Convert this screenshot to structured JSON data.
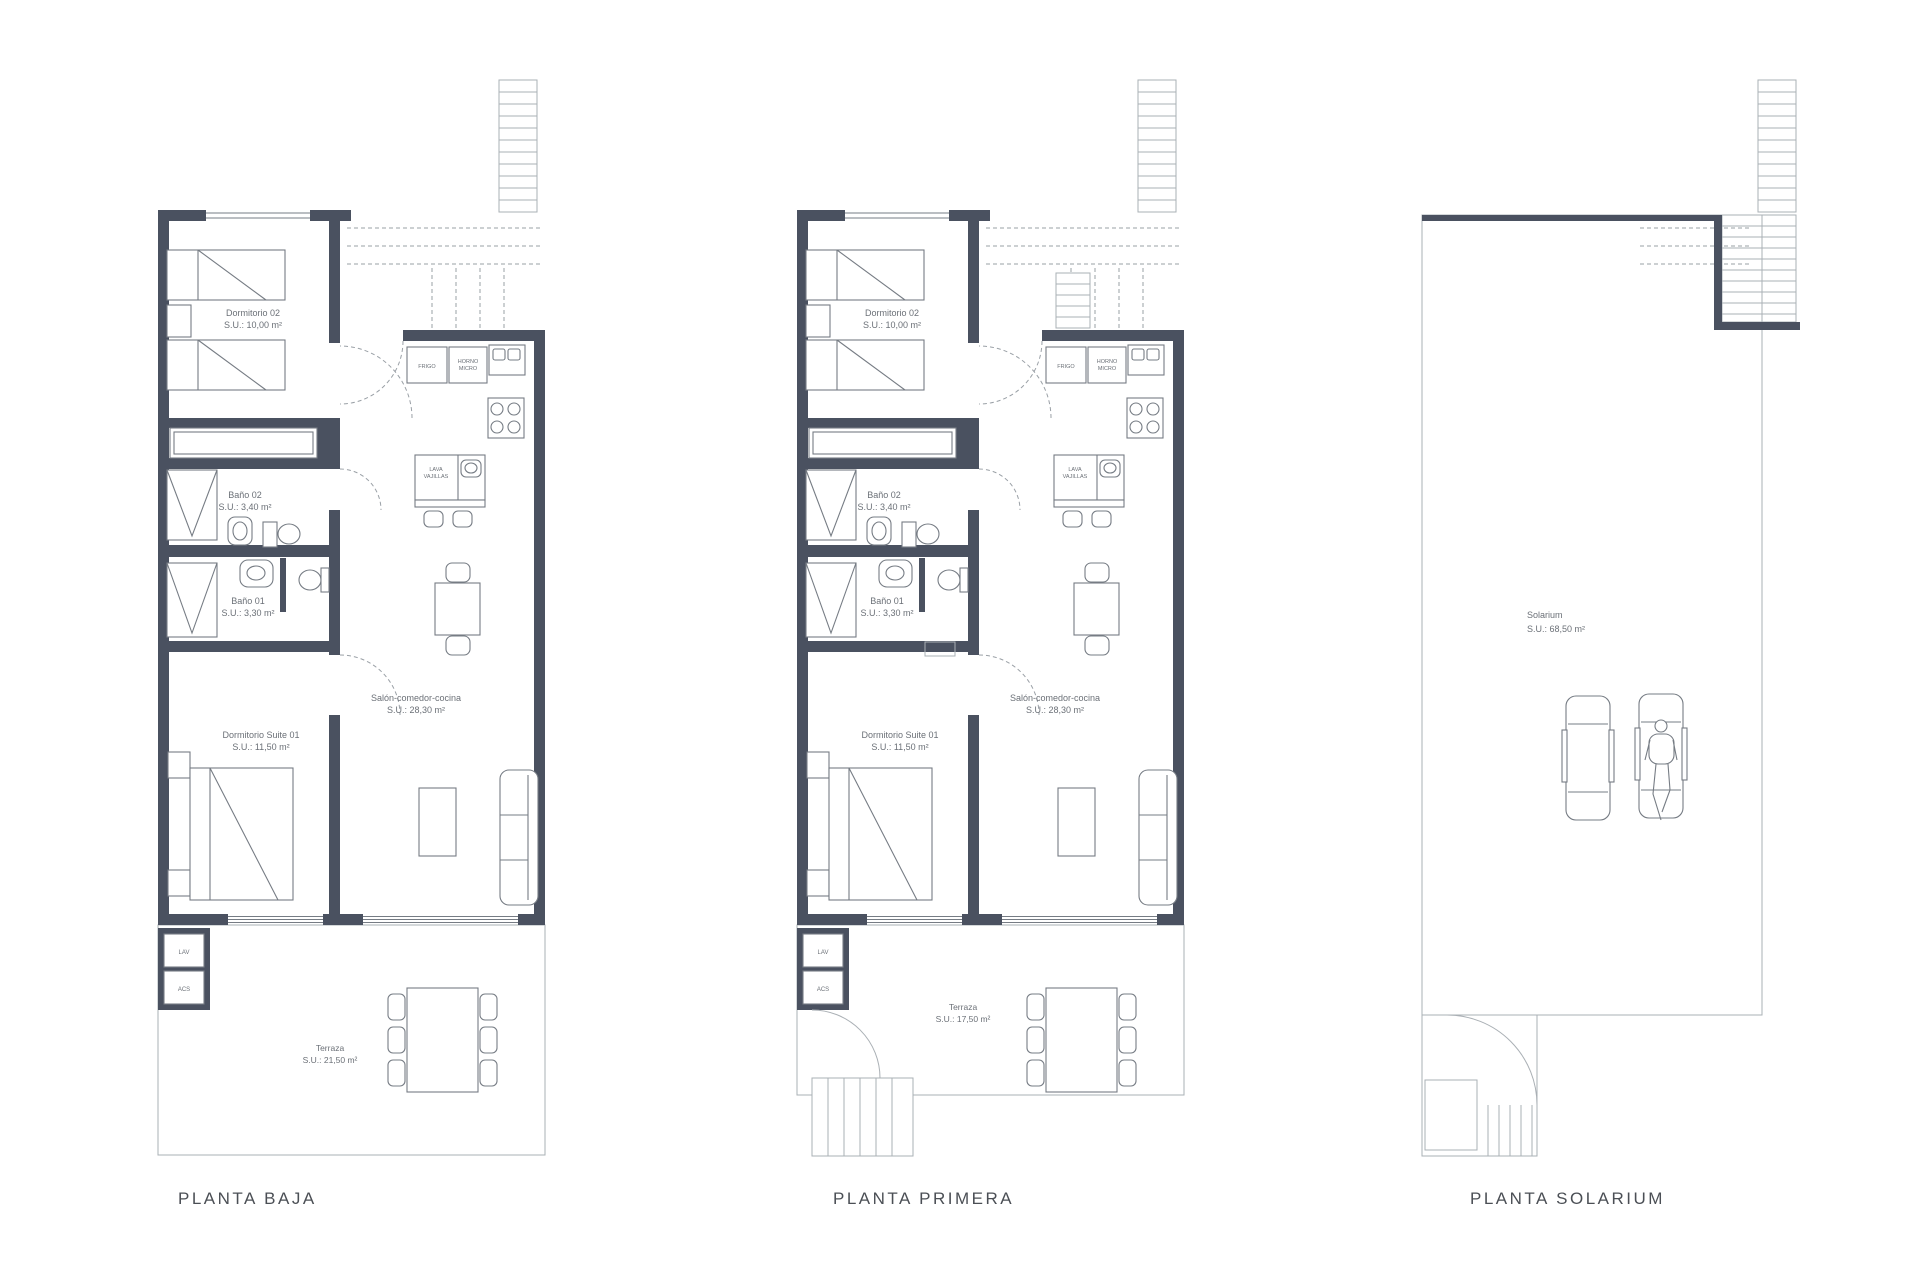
{
  "colors": {
    "wall": "#4a5160",
    "line": "#767c84",
    "text": "#6b7077",
    "title": "#4b4f55",
    "deck": "#c6cacd",
    "dash": "#9aa0a6",
    "thin": "#aab0b5"
  },
  "unit": {
    "dormitorio02": {
      "name": "Dormitorio 02",
      "area": "S.U.: 10,00 m²"
    },
    "bano02": {
      "name": "Baño 02",
      "area": "S.U.: 3,40 m²"
    },
    "bano01": {
      "name": "Baño 01",
      "area": "S.U.: 3,30 m²"
    },
    "suite": {
      "name": "Dormitorio Suite 01",
      "area": "S.U.: 11,50 m²"
    },
    "salon": {
      "name": "Salón-comedor-cocina",
      "area": "S.U.: 28,30 m²"
    },
    "kitchen": {
      "frigo": "FRIGO",
      "horno1": "HORNO",
      "horno2": "MICRO",
      "lava1": "LAVA",
      "lava2": "VAJILLAS"
    },
    "closet": {
      "lav": "LAV",
      "acs": "ACS"
    }
  },
  "plans": {
    "baja": {
      "title": "PLANTA BAJA",
      "terraza": {
        "name": "Terraza",
        "area": "S.U.: 21,50 m²"
      }
    },
    "primera": {
      "title": "PLANTA PRIMERA",
      "terraza": {
        "name": "Terraza",
        "area": "S.U.: 17,50 m²"
      }
    },
    "solarium": {
      "title": "PLANTA SOLARIUM",
      "room": {
        "name": "Solarium",
        "area": "S.U.: 68,50 m²"
      }
    }
  }
}
